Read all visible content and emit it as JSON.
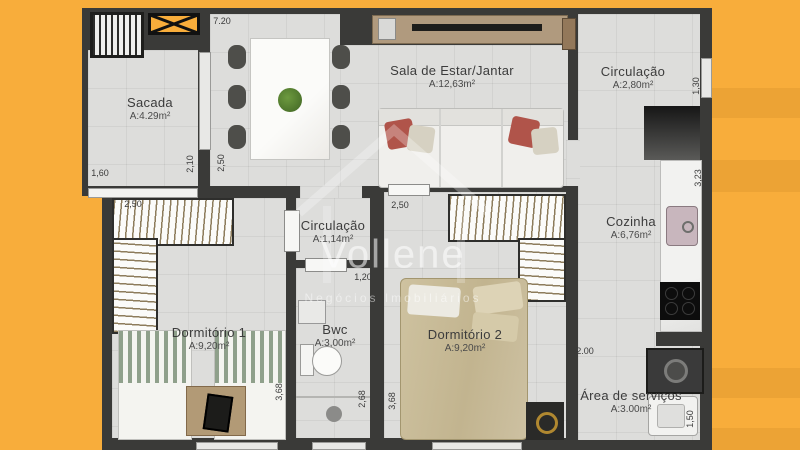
{
  "watermark": {
    "brand": "Vollene",
    "subtitle": "Negócios Imobiliários"
  },
  "rooms": [
    {
      "id": "sacada",
      "name": "Sacada",
      "area": "A:4.29m²"
    },
    {
      "id": "sala-estar-jantar",
      "name": "Sala de Estar/Jantar",
      "area": "A:12,63m²"
    },
    {
      "id": "circulacao-entrada",
      "name": "Circulação",
      "area": "A:2,80m²"
    },
    {
      "id": "cozinha",
      "name": "Cozinha",
      "area": "A:6,76m²"
    },
    {
      "id": "circulacao-interna",
      "name": "Circulação",
      "area": "A:1,14m²"
    },
    {
      "id": "bwc",
      "name": "Bwc",
      "area": "A:3,00m²"
    },
    {
      "id": "dormitorio-1",
      "name": "Dormitório 1",
      "area": "A:9,20m²"
    },
    {
      "id": "dormitorio-2",
      "name": "Dormitório 2",
      "area": "A:9,20m²"
    },
    {
      "id": "area-servicos",
      "name": "Área de serviços",
      "area": "A:3.00m²"
    }
  ],
  "dimensions": [
    {
      "id": "top-width",
      "value": "7.20"
    },
    {
      "id": "sacada-width",
      "value": "1,60"
    },
    {
      "id": "sacada-depth",
      "value": "2,10"
    },
    {
      "id": "dining-depth",
      "value": "2,50"
    },
    {
      "id": "dorm1-width",
      "value": "2,50"
    },
    {
      "id": "dorm2-width",
      "value": "2,50"
    },
    {
      "id": "circulacao-depth",
      "value": "1,30"
    },
    {
      "id": "cozinha-depth",
      "value": "3,23"
    },
    {
      "id": "bwc-width",
      "value": "1,20"
    },
    {
      "id": "bwc-depth",
      "value": "2,68"
    },
    {
      "id": "dorm1-depth",
      "value": "3,68"
    },
    {
      "id": "dorm2-depth",
      "value": "3,68"
    },
    {
      "id": "cozinha-width",
      "value": "2.00"
    },
    {
      "id": "servicos-depth",
      "value": "1,50"
    }
  ],
  "colors": {
    "background_orange": "#F8AD3B",
    "stripe_orange": "#EFA02C",
    "wall_dark": "#3A3A38",
    "floor_gray": "#DDDDDB",
    "pillow_red": "#B0544A",
    "bed_khaki": "#C8BB98"
  }
}
